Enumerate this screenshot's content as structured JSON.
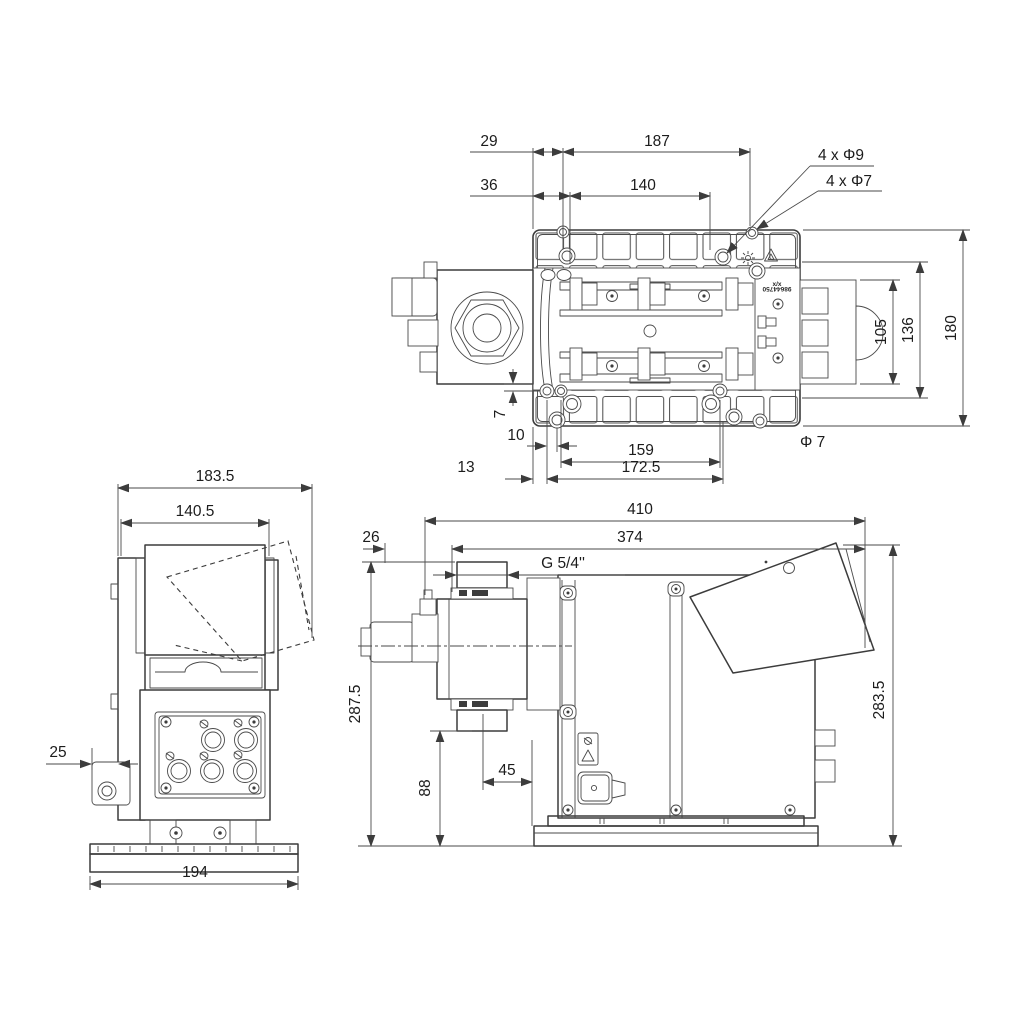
{
  "drawing": {
    "type": "technical-dimensional-drawing",
    "subject": "dosing-pump",
    "units": "mm",
    "line_color": "#3c3c3c",
    "background": "#ffffff"
  },
  "views": {
    "top": {
      "label": "top-view-mounting-plate",
      "dims": {
        "d29": "29",
        "d187": "187",
        "d36": "36",
        "d140": "140",
        "leader_phi9": "4 x Φ9",
        "leader_phi7": "4 x Φ7",
        "d105": "105",
        "d136": "136",
        "d180": "180",
        "d7": "7",
        "d10": "10",
        "d159": "159",
        "phi7": "Φ 7",
        "d13": "13",
        "d172_5": "172.5"
      },
      "nameplate": {
        "l1": "x/x",
        "l2": "98644750"
      }
    },
    "front": {
      "label": "front-view",
      "dims": {
        "d183_5": "183.5",
        "d140_5": "140.5",
        "d25": "25",
        "d194": "194"
      }
    },
    "side": {
      "label": "side-view",
      "dims": {
        "d410": "410",
        "d374": "374",
        "d26": "26",
        "g54": "G 5/4''",
        "d287_5": "287.5",
        "d88": "88",
        "d45": "45",
        "d283_5": "283.5"
      }
    }
  }
}
